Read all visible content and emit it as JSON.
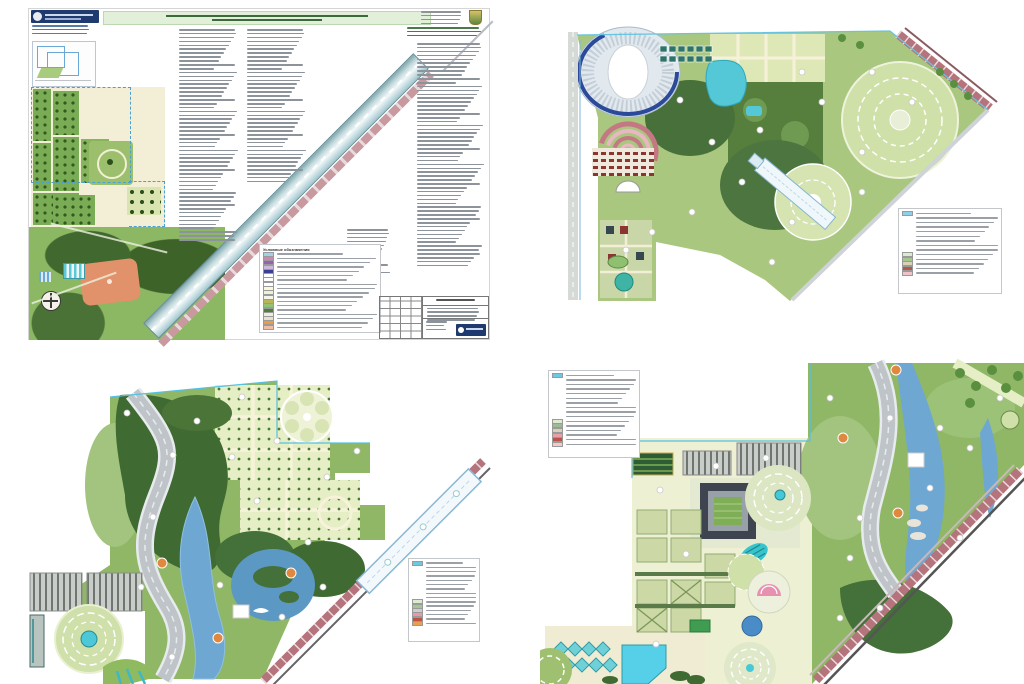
{
  "board": {
    "background": "#ffffff"
  },
  "palette": {
    "lawn": "#a9c77e",
    "lawn_dark": "#8fb766",
    "forest": "#44703a",
    "formal_garden": "#e6eec6",
    "path_cream": "#f3efd6",
    "water": "#6ea7d2",
    "pool_teal": "#55c8d8",
    "ribbon_gray": "#bfc4c9",
    "road_red": "#b5737c",
    "node_orange": "#e08840",
    "boundary_cyan": "#55c0e0",
    "stadium_ring_blue": "#2c4a9a",
    "header_bar_green": "#e2f0da",
    "logo_navy": "#1e3a6e",
    "sports_field_orange": "#e2926b"
  },
  "sheet1": {
    "legend": {
      "header": "Условные обозначения",
      "rows": [
        "#9fd4e8",
        "#d483b8",
        "#9763ab",
        "#cbb8de",
        "#3c3f8f",
        "#ffffff",
        "#ffffff",
        "#ffffff",
        "#fbf8dc",
        "#e9f3d9",
        "#f5f5ec",
        "#b9b657",
        "#93c273",
        "#4f7e3e",
        "#efeddd",
        "#e6e2cf",
        "#e59f42",
        "#f2bca3"
      ]
    },
    "columns": {
      "title_lines": 2,
      "logo_note_lines": 3,
      "corner_note_lines": 4,
      "corner_green_lines": 3,
      "inset_caption_lines": 1,
      "col1_lines": 55,
      "col2_lines": 40,
      "col3_lines": 58,
      "sub_lines": 12,
      "stamp_lines": 4
    }
  },
  "plan2": {
    "legend_rows": [
      "#8fd0e8",
      null,
      null,
      null,
      null,
      null,
      null,
      null,
      null,
      "#dcead2",
      "#a6c690",
      "#d8d2b4",
      "#b5574a",
      "#f0c2c8"
    ]
  },
  "plan3": {
    "legend_rows": [
      "#6fc8e2",
      null,
      null,
      null,
      null,
      null,
      null,
      null,
      null,
      "#dcead2",
      "#a6c690",
      "#cccccc",
      "#e89aa4",
      "#c0504a",
      "#e8a04a"
    ]
  },
  "plan4": {
    "legend_rows": [
      "#6fc8e2",
      null,
      null,
      null,
      null,
      null,
      null,
      null,
      null,
      null,
      "#dcead2",
      "#9fb896",
      "#d8d2b4",
      "#e8a0a8",
      "#c0504a",
      "#f0caca"
    ]
  }
}
